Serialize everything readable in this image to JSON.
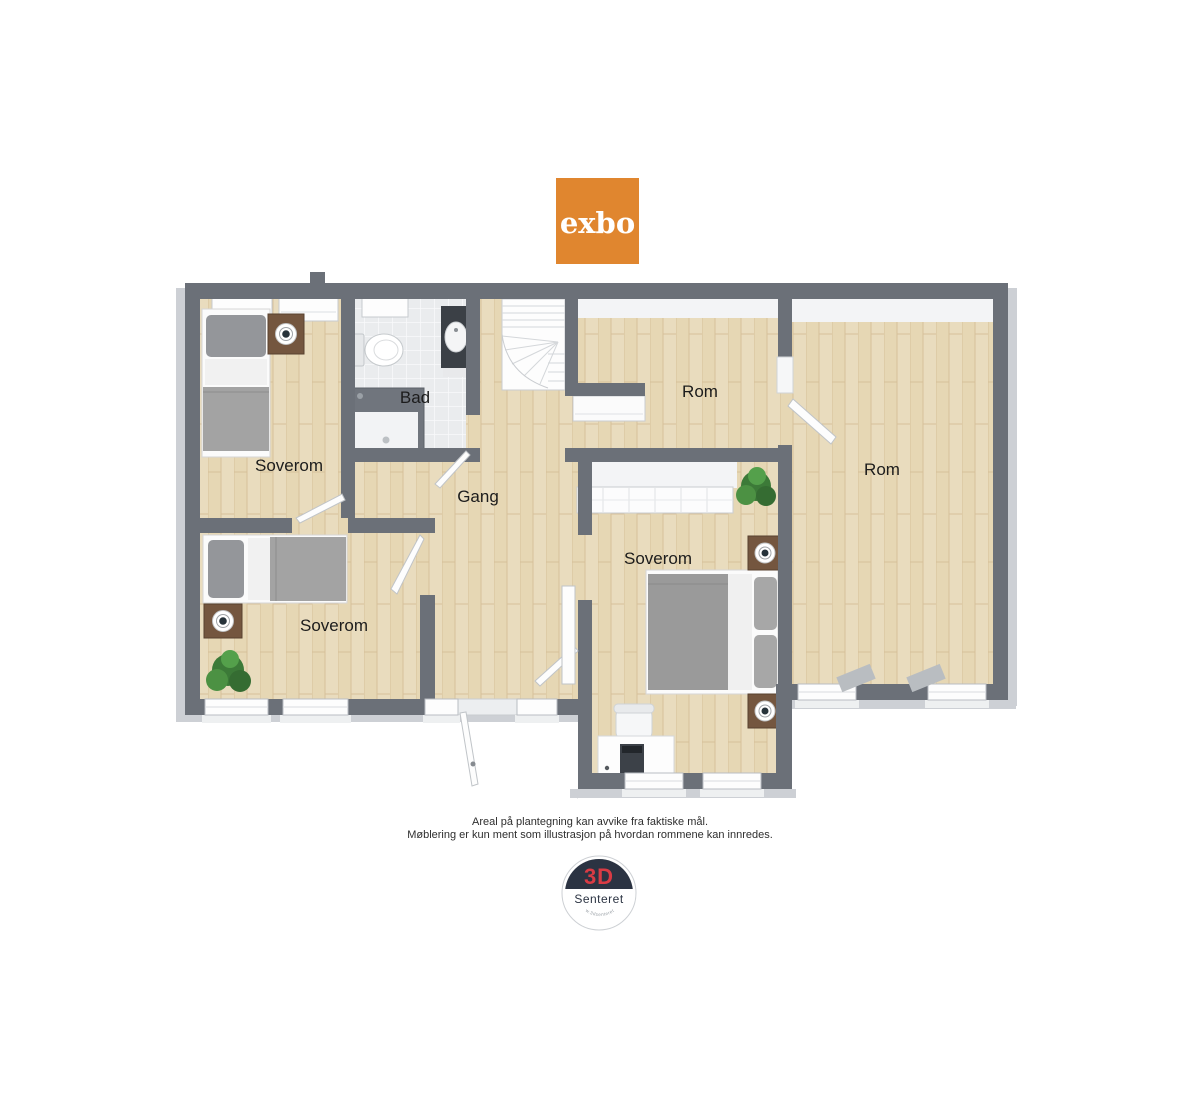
{
  "branding": {
    "exbo_text": "exbo",
    "exbo_bg_color": "#E0862F",
    "senteret_top": "3D",
    "senteret_name": "Senteret",
    "senteret_url": "www.3dsenteret.no",
    "senteret_red": "#D93B44",
    "senteret_navy": "#2B3342"
  },
  "floorplan": {
    "labels": [
      {
        "id": "soverom-top-left",
        "text": "Soverom"
      },
      {
        "id": "bad",
        "text": "Bad"
      },
      {
        "id": "gang",
        "text": "Gang"
      },
      {
        "id": "rom-top",
        "text": "Rom"
      },
      {
        "id": "rom-right",
        "text": "Rom"
      },
      {
        "id": "soverom-middle",
        "text": "Soverom"
      },
      {
        "id": "soverom-bottom-left",
        "text": "Soverom"
      }
    ],
    "colors": {
      "wall": "#6B7078",
      "wall_skirt": "#CDD0D5",
      "floor_wood": "#E9DCBE",
      "floor_tile": "#EAECEE",
      "furniture_gray": "#9B9B9B",
      "plant_green": "#3F7F3B"
    }
  },
  "disclaimer": {
    "line1": "Areal på plantegning kan avvike fra faktiske mål.",
    "line2": "Møblering er kun ment som illustrasjon på hvordan rommene kan innredes."
  }
}
